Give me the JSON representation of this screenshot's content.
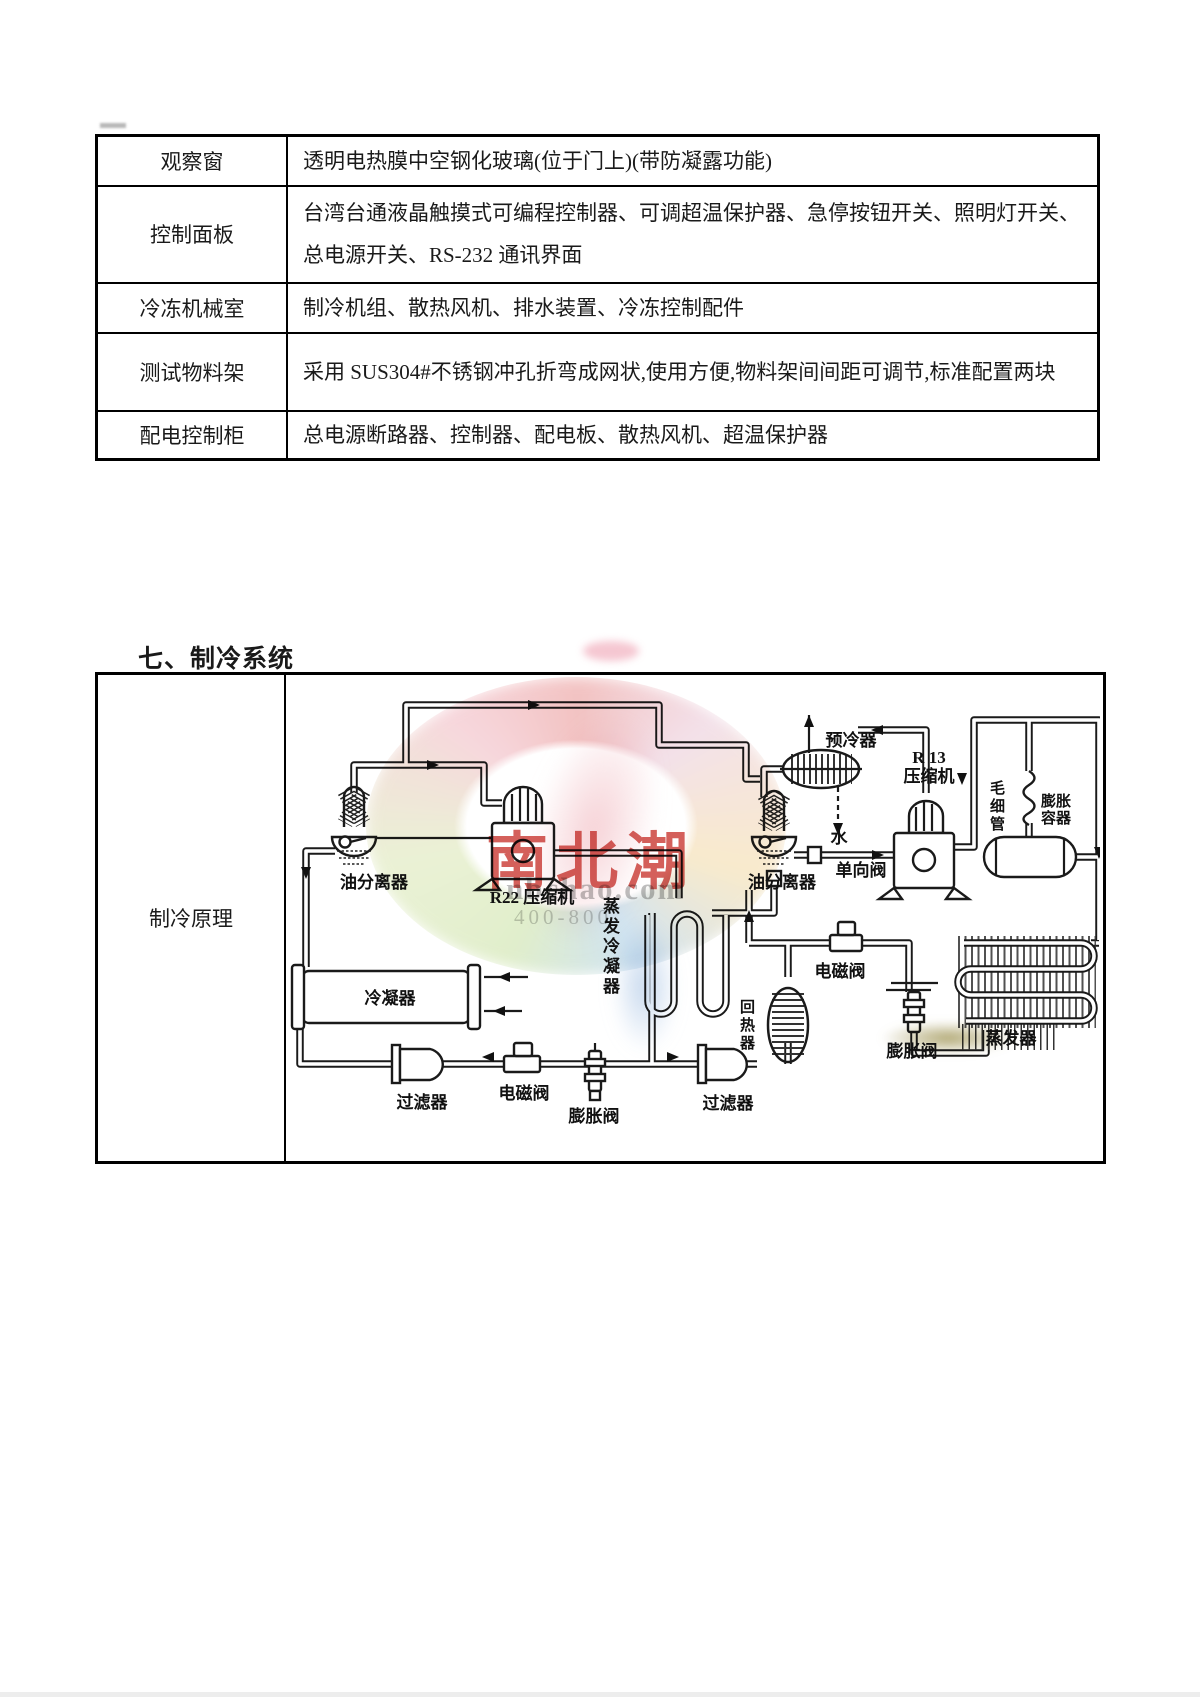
{
  "spec_table": {
    "rows": [
      {
        "label": "观察窗",
        "value": "透明电热膜中空钢化玻璃(位于门上)(带防凝露功能)"
      },
      {
        "label": "控制面板",
        "value": "台湾台通液晶触摸式可编程控制器、可调超温保护器、急停按钮开关、照明灯开关、总电源开关、RS-232 通讯界面"
      },
      {
        "label": "冷冻机械室",
        "value": "制冷机组、散热风机、排水装置、冷冻控制配件"
      },
      {
        "label": "测试物料架",
        "value": "采用 SUS304#不锈钢冲孔折弯成网状,使用方便,物料架间间距可调节,标准配置两块"
      },
      {
        "label": "配电控制柜",
        "value": "总电源断路器、控制器、配电板、散热风机、超温保护器"
      }
    ]
  },
  "section_heading": "七、制冷系统",
  "principle_table": {
    "row_label": "制冷原理"
  },
  "diagram": {
    "labels": {
      "precooler": "预冷器",
      "r13_line1": "R 13",
      "r13_line2": "压缩机",
      "capillary": "毛细管",
      "expvessel_line1": "膨胀",
      "expvessel_line2": "容器",
      "water": "水",
      "check_valve": "单向阀",
      "oil_sep_left": "油分离器",
      "oil_sep_right": "油分离器",
      "r22_compressor": "R22 压缩机",
      "evap_condenser": "蒸发冷凝器",
      "condenser": "冷凝器",
      "filter_left": "过滤器",
      "solenoid_bottom": "电磁阀",
      "expvalve_bottom": "膨胀阀",
      "filter_right": "过滤器",
      "regenerator": "回热器",
      "solenoid_right": "电磁阀",
      "expvalve_right": "膨胀阀",
      "evaporator": "蒸发器"
    }
  },
  "watermark": {
    "brand": "南北潮",
    "domain": "nbchao.com",
    "phone": "400-800"
  }
}
